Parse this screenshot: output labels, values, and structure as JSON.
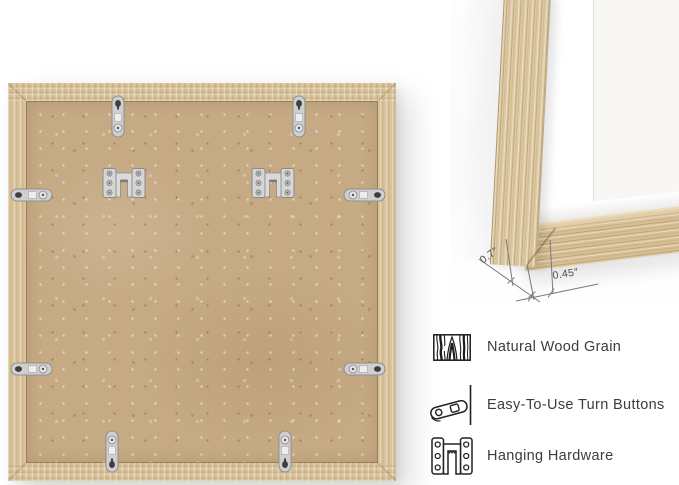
{
  "detail_view": {
    "dimensions": {
      "frame_depth": "0.7″",
      "frame_face_width": "0.45″"
    }
  },
  "features": [
    {
      "icon": "wood-grain-icon",
      "label": "Natural Wood Grain"
    },
    {
      "icon": "turn-button-icon",
      "label": "Easy-To-Use Turn Buttons"
    },
    {
      "icon": "hanging-hardware-icon",
      "label": "Hanging Hardware"
    }
  ],
  "colors": {
    "bg": "#ffffff",
    "wood": "#d9c39c",
    "mdf": "#c6aa84",
    "metal": "#cfcfcf",
    "metal-dark": "#8f8f8f",
    "mat-white": "#ffffff",
    "text": "#3c3c3c",
    "dim-line": "#777777"
  }
}
